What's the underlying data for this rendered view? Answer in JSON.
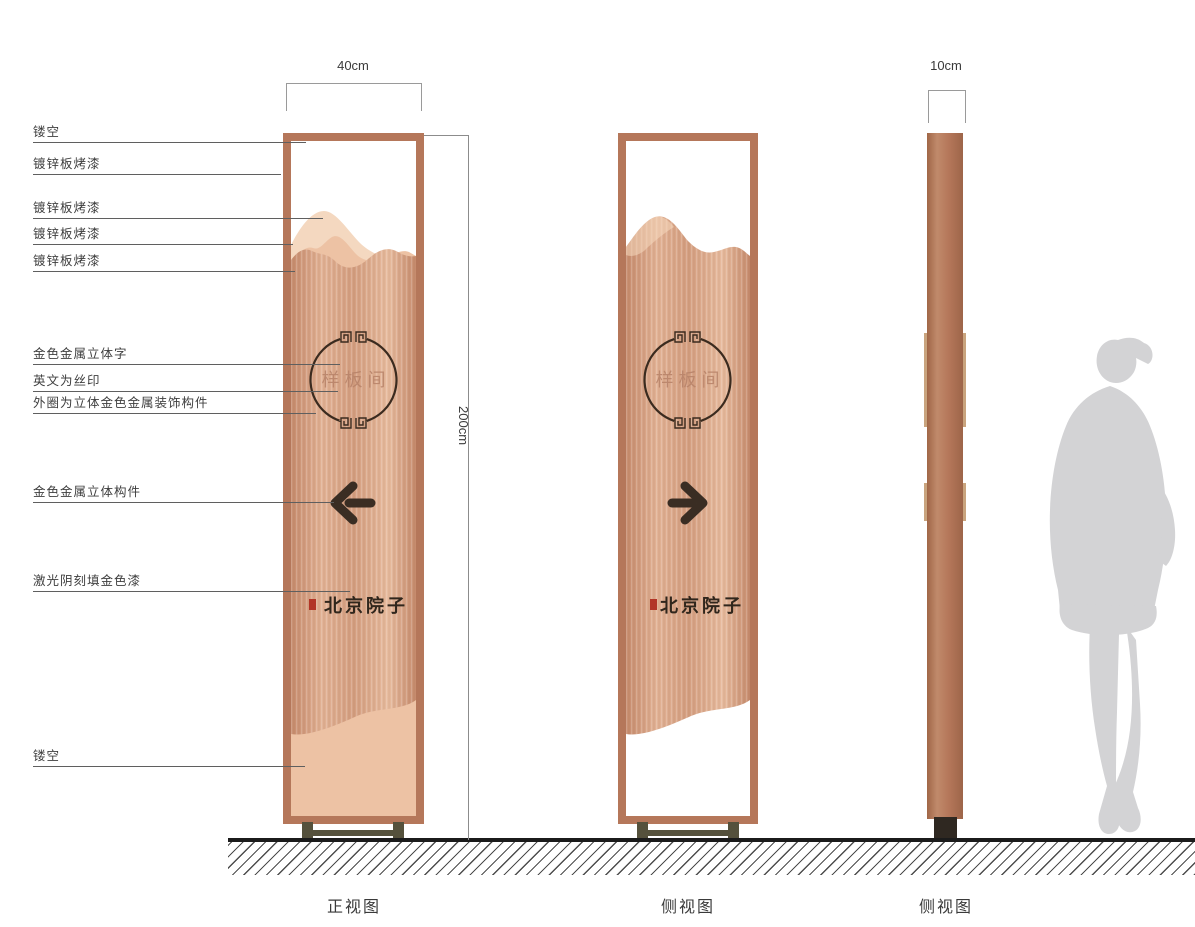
{
  "callouts": [
    {
      "text": "镂空"
    },
    {
      "text": "镀锌板烤漆"
    },
    {
      "text": "镀锌板烤漆"
    },
    {
      "text": "镀锌板烤漆"
    },
    {
      "text": "镀锌板烤漆"
    },
    {
      "text": "金色金属立体字"
    },
    {
      "text": "英文为丝印"
    },
    {
      "text": "外圈为立体金色金属装饰构件"
    },
    {
      "text": "金色金属立体构件"
    },
    {
      "text": "激光阴刻填金色漆"
    },
    {
      "text": "镂空"
    }
  ],
  "dimensions": {
    "front_width": "40cm",
    "height": "200cm",
    "side_thickness": "10cm"
  },
  "signs": {
    "front": {
      "circle_text": "样板间",
      "brand_text": "北京院子",
      "arrow": "left-arrow"
    },
    "side": {
      "circle_text": "样板间",
      "brand_text": "北京院子",
      "arrow": "right-arrow"
    }
  },
  "view_labels": [
    {
      "label": "正视图"
    },
    {
      "label": "侧视图"
    },
    {
      "label": "侧视图"
    }
  ],
  "icons": {
    "front_arrow": "left-arrow",
    "side_arrow": "right-arrow",
    "circle_ornament": "fret-ring",
    "seal": "red-seal-stamp"
  },
  "colors": {
    "copper_frame": "#b5775a",
    "copper_body_light": "#e2b295",
    "copper_body_dark": "#c68b6d",
    "mountain_light": "#f4d8c0",
    "mountain_mid": "#edc2a4",
    "ink": "#30261c",
    "seal_red": "#b23527",
    "base_olive": "#55513c",
    "silhouette_gray": "#d3d3d5"
  }
}
